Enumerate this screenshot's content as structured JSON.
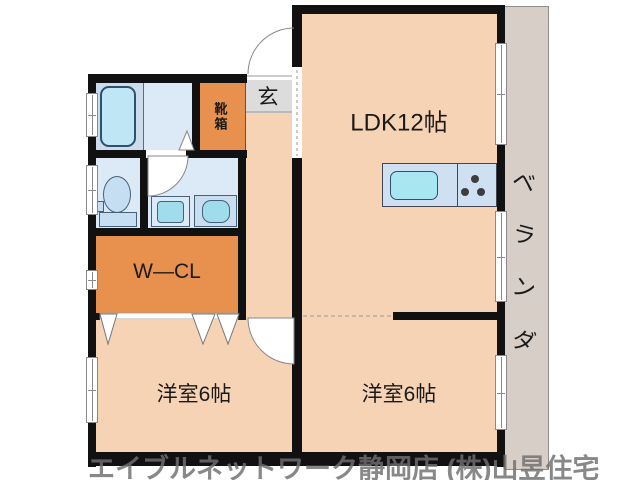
{
  "floor_plan": {
    "rooms": {
      "ldk": "LDK12帖",
      "bedroom_left": "洋室6帖",
      "bedroom_right": "洋室6帖",
      "walk_in_closet": "W―CL",
      "entrance": "玄",
      "shoe_box": "靴箱",
      "veranda": "ベランダ",
      "veranda_chars": [
        "ベ",
        "ラ",
        "ン",
        "ダ"
      ]
    },
    "watermark": "エイブルネットワーク静岡店 (株)山昱住宅",
    "colors": {
      "room_floor": "#f6d3b4",
      "closet_orange": "#e8914e",
      "wet_area_blue": "#dce9f7",
      "bath_blue": "#ccdcec",
      "fixture_blue": "#a5dff0",
      "veranda_gray": "#d7cec7",
      "entrance_gray": "#dcdcdc",
      "wall_black": "#111111"
    }
  }
}
